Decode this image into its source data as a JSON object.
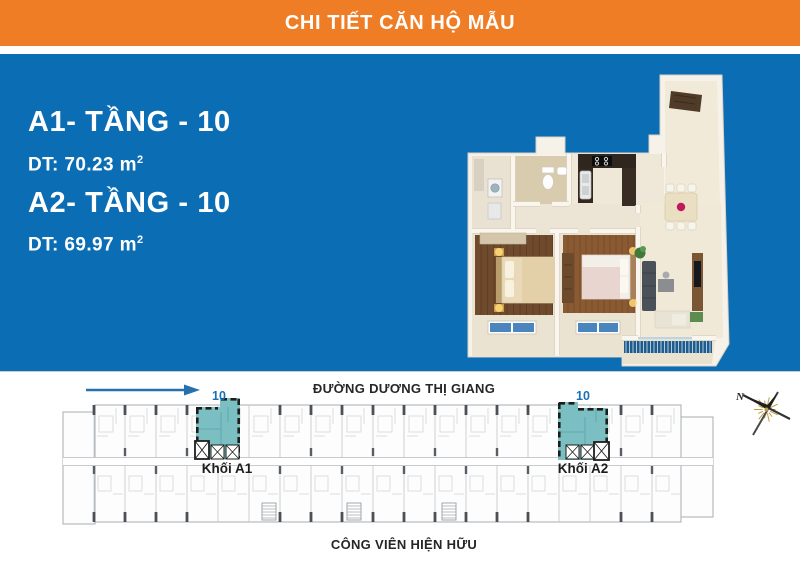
{
  "header": {
    "title": "CHI TIẾT CĂN HỘ MẪU"
  },
  "panel": {
    "units": [
      {
        "name": "A1- TẦNG - 10",
        "area_label": "DT: 70.23 m",
        "area_sup": "2"
      },
      {
        "name": "A2- TẦNG - 10",
        "area_label": "DT: 69.97 m",
        "area_sup": "2"
      }
    ]
  },
  "siteplan": {
    "street_top": "ĐƯỜNG DƯƠNG THỊ GIANG",
    "street_bottom": "CÔNG VIÊN HIỆN HỮU",
    "blocks": [
      {
        "floor": "10",
        "label": "Khối A1"
      },
      {
        "floor": "10",
        "label": "Khối A2"
      }
    ],
    "compass_north": "N"
  },
  "colors": {
    "header_orange": "#EE7D25",
    "panel_blue": "#0B6DB4",
    "highlight_teal": "#7BBFC2",
    "label_blue": "#1B70B5",
    "text_dark": "#1D1D1B",
    "arrow_blue": "#2471AD"
  }
}
